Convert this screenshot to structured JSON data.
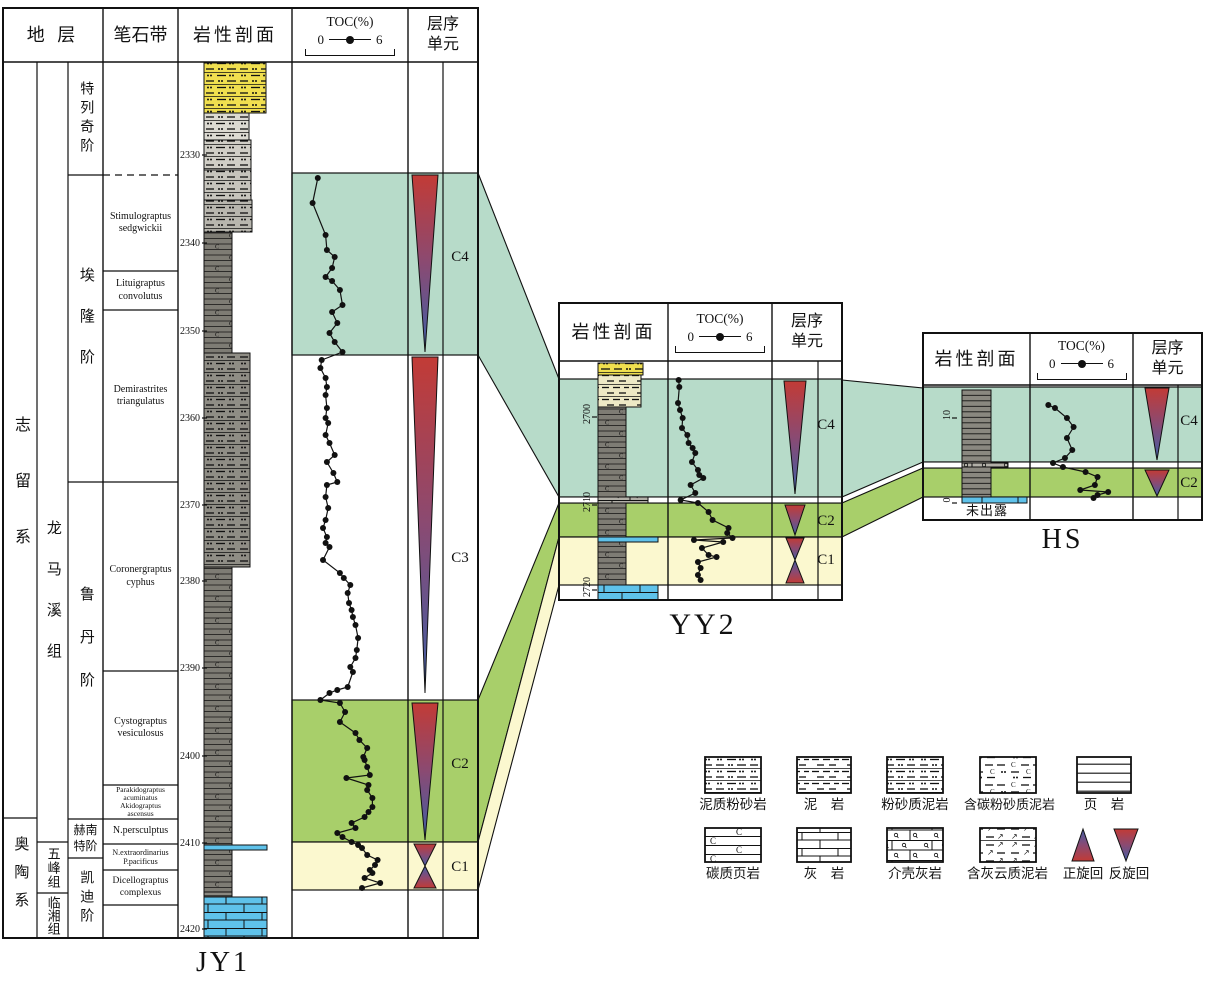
{
  "palette": {
    "teal": "#b7dbc9",
    "green": "#a8cf6a",
    "cream": "#fbf8cf",
    "red": "#c23b36",
    "blue": "#3f5fa7",
    "line": "#111111",
    "lith": {
      "yellow": "#f0df4f",
      "pale": "#eee9c5",
      "g1": "#dcdad2",
      "g15": "#d0cec6",
      "g2": "#c6c4bc",
      "g25": "#b8b6ae",
      "dk": "#7e7c74",
      "dkdash": "#8f8d85",
      "shale": "#8a8880",
      "blue": "#5fc2ea",
      "lime": "#5fc2ea",
      "shellb": "#b2b0a8"
    }
  },
  "headers": {
    "strata": "地 层",
    "biozone": "笔石带",
    "lithology": "岩性剖面",
    "toc_title": "TOC(%)",
    "toc_min": "0",
    "toc_max": "6",
    "sequence": "层序单元"
  },
  "jy1": {
    "well_label": "JY1",
    "series": [
      {
        "label": "志留系"
      },
      {
        "label": "奥陶系"
      }
    ],
    "formations": [
      {
        "label": "龙马溪组"
      },
      {
        "label": "五峰组"
      },
      {
        "label": "临湘组"
      }
    ],
    "stages": [
      {
        "label": "特列奇阶"
      },
      {
        "label": "埃隆阶"
      },
      {
        "label": "鲁丹阶"
      },
      {
        "label": "赫南特阶"
      },
      {
        "label": "凯迪阶"
      }
    ],
    "biozones": [
      {
        "label": "Stimulograptus\nsedgwickii"
      },
      {
        "label": "Lituigraptus\nconvolutus"
      },
      {
        "label": "Demirastrites\ntriangulatus"
      },
      {
        "label": "Coronergraptus\ncyphus"
      },
      {
        "label": "Cystograptus\nvesiculosus"
      },
      {
        "label": "Parakidograptus\nacuminatus\nAkidograptus\nascensus"
      },
      {
        "label": "N.persculptus"
      },
      {
        "label": "N.extraordinarius\nP.pacificus"
      },
      {
        "label": "Dicellograptus\ncomplexus"
      }
    ],
    "sequence_labels": [
      {
        "label": "C4"
      },
      {
        "label": "C3"
      },
      {
        "label": "C2"
      },
      {
        "label": "C1"
      }
    ],
    "toc_curve": [
      [
        178,
        0.6
      ],
      [
        203,
        0.2
      ],
      [
        235,
        1.2
      ],
      [
        250,
        1.3
      ],
      [
        257,
        1.9
      ],
      [
        268,
        1.7
      ],
      [
        277,
        1.2
      ],
      [
        281,
        1.7
      ],
      [
        290,
        2.3
      ],
      [
        305,
        2.5
      ],
      [
        312,
        1.7
      ],
      [
        323,
        2.1
      ],
      [
        333,
        1.5
      ],
      [
        342,
        1.9
      ],
      [
        352,
        2.5
      ],
      [
        360,
        0.9
      ],
      [
        368,
        0.8
      ],
      [
        378,
        1.2
      ],
      [
        387,
        1.3
      ],
      [
        395,
        1.2
      ],
      [
        408,
        1.3
      ],
      [
        418,
        1.2
      ],
      [
        423,
        1.4
      ],
      [
        435,
        1.2
      ],
      [
        443,
        1.5
      ],
      [
        455,
        1.9
      ],
      [
        462,
        1.3
      ],
      [
        473,
        1.8
      ],
      [
        482,
        2.1
      ],
      [
        485,
        1.3
      ],
      [
        497,
        1.2
      ],
      [
        508,
        1.4
      ],
      [
        520,
        1.2
      ],
      [
        528,
        1.0
      ],
      [
        537,
        1.3
      ],
      [
        543,
        1.2
      ],
      [
        547,
        1.5
      ],
      [
        560,
        1.0
      ],
      [
        573,
        2.3
      ],
      [
        578,
        2.6
      ],
      [
        585,
        3.1
      ],
      [
        593,
        2.9
      ],
      [
        603,
        3.0
      ],
      [
        610,
        3.2
      ],
      [
        617,
        3.3
      ],
      [
        625,
        3.5
      ],
      [
        638,
        3.7
      ],
      [
        650,
        3.6
      ],
      [
        658,
        3.5
      ],
      [
        667,
        3.1
      ],
      [
        672,
        3.3
      ],
      [
        687,
        2.9
      ],
      [
        690,
        2.1
      ],
      [
        693,
        1.5
      ],
      [
        700,
        0.8
      ],
      [
        703,
        2.3
      ],
      [
        712,
        2.7
      ],
      [
        722,
        2.3
      ],
      [
        733,
        3.5
      ],
      [
        740,
        3.8
      ],
      [
        748,
        4.4
      ],
      [
        757,
        4.1
      ],
      [
        760,
        4.2
      ],
      [
        767,
        4.4
      ],
      [
        775,
        4.6
      ],
      [
        778,
        2.8
      ],
      [
        785,
        4.5
      ],
      [
        790,
        4.4
      ],
      [
        798,
        4.8
      ],
      [
        807,
        4.8
      ],
      [
        812,
        4.5
      ],
      [
        817,
        4.2
      ],
      [
        823,
        3.2
      ],
      [
        828,
        3.5
      ],
      [
        833,
        2.1
      ],
      [
        837,
        2.5
      ],
      [
        842,
        3.2
      ],
      [
        845,
        3.7
      ],
      [
        848,
        4.0
      ],
      [
        855,
        4.4
      ],
      [
        860,
        5.2
      ],
      [
        865,
        5.0
      ],
      [
        870,
        4.6
      ],
      [
        873,
        4.8
      ],
      [
        878,
        4.2
      ],
      [
        883,
        5.4
      ],
      [
        888,
        4.0
      ]
    ],
    "gfx": {
      "frame": [
        3,
        8,
        475,
        930
      ],
      "header_bottom": 62,
      "cols": [
        103,
        178,
        292,
        408
      ],
      "body_cols": [
        37,
        68,
        443
      ],
      "hlines": [
        [
          3,
          37,
          818
        ],
        [
          37,
          68,
          842
        ],
        [
          37,
          68,
          893
        ],
        [
          68,
          103,
          175
        ],
        [
          68,
          103,
          482
        ],
        [
          68,
          103,
          819
        ],
        [
          68,
          103,
          858
        ],
        [
          103,
          178,
          271
        ],
        [
          103,
          178,
          310
        ],
        [
          103,
          178,
          482
        ],
        [
          103,
          178,
          671
        ],
        [
          103,
          178,
          785
        ],
        [
          103,
          178,
          819
        ],
        [
          103,
          178,
          844
        ],
        [
          103,
          178,
          870
        ],
        [
          103,
          178,
          905
        ]
      ],
      "dashed_hlines": [
        [
          103,
          178,
          175
        ]
      ],
      "band_x": [
        292,
        478
      ],
      "bands": [
        [
          "C4",
          "teal",
          173,
          355
        ],
        [
          "C2",
          "green",
          700,
          842
        ],
        [
          "C1",
          "cream",
          842,
          890
        ]
      ],
      "white_strips": [],
      "lith_x": 204,
      "lith": [
        [
          63,
          50,
          62,
          "yellow"
        ],
        [
          113,
          27,
          45,
          "g1"
        ],
        [
          140,
          30,
          47,
          "g15"
        ],
        [
          170,
          30,
          47,
          "g2"
        ],
        [
          200,
          32,
          48,
          "g25"
        ],
        [
          232,
          121,
          28,
          "dk"
        ],
        [
          353,
          214,
          46,
          "dkdash"
        ],
        [
          567,
          278,
          28,
          "dk"
        ],
        [
          845,
          5,
          63,
          "blue"
        ],
        [
          850,
          42,
          28,
          "dk"
        ],
        [
          892,
          5,
          28,
          "shale"
        ],
        [
          897,
          41,
          63,
          "lime"
        ]
      ],
      "ticks": {
        "x": 202,
        "rot": false,
        "items": [
          [
            "2330",
            155
          ],
          [
            "2340",
            243
          ],
          [
            "2350",
            331
          ],
          [
            "2360",
            418
          ],
          [
            "2370",
            505
          ],
          [
            "2380",
            581
          ],
          [
            "2390",
            668
          ],
          [
            "2400",
            756
          ],
          [
            "2410",
            843
          ],
          [
            "2420",
            929
          ]
        ]
      },
      "toc": {
        "x0": 310,
        "per": 13
      },
      "cycles": [
        [
          "rev",
          425,
          175,
          352,
          13
        ],
        [
          "rev",
          425,
          357,
          693,
          13
        ],
        [
          "rev",
          425,
          703,
          840,
          13
        ],
        [
          "rev",
          425,
          844,
          866,
          11
        ],
        [
          "fwd",
          425,
          866,
          888,
          11
        ]
      ]
    }
  },
  "yy2": {
    "well_label": "YY2",
    "sequence_labels": [
      {
        "label": "C4"
      },
      {
        "label": "C2"
      },
      {
        "label": "C1"
      }
    ],
    "toc_curve": [
      [
        380,
        0.05
      ],
      [
        387,
        0.1
      ],
      [
        403,
        0.0
      ],
      [
        410,
        0.15
      ],
      [
        418,
        0.35
      ],
      [
        428,
        0.3
      ],
      [
        435,
        0.7
      ],
      [
        443,
        0.8
      ],
      [
        448,
        1.1
      ],
      [
        453,
        1.3
      ],
      [
        462,
        1.05
      ],
      [
        470,
        1.5
      ],
      [
        475,
        1.6
      ],
      [
        478,
        1.9
      ],
      [
        485,
        0.95
      ],
      [
        493,
        1.3
      ],
      [
        500,
        0.2
      ],
      [
        503,
        1.5
      ],
      [
        512,
        2.3
      ],
      [
        520,
        2.6
      ],
      [
        528,
        3.8
      ],
      [
        533,
        3.7
      ],
      [
        538,
        4.1
      ],
      [
        540,
        1.2
      ],
      [
        542,
        3.4
      ],
      [
        548,
        1.8
      ],
      [
        555,
        2.3
      ],
      [
        557,
        2.9
      ],
      [
        562,
        1.5
      ],
      [
        568,
        1.7
      ],
      [
        575,
        1.5
      ],
      [
        580,
        1.7
      ]
    ],
    "gfx": {
      "frame": [
        559,
        303,
        283,
        297
      ],
      "header_bottom": 361,
      "cols": [
        668,
        772
      ],
      "body_cols": [
        818
      ],
      "hlines": [],
      "dashed_hlines": [],
      "band_x": [
        559,
        842
      ],
      "bands": [
        [
          "C4",
          "teal",
          379,
          497
        ],
        [
          "C2",
          "green",
          503,
          537
        ],
        [
          "C1",
          "cream",
          537,
          585
        ]
      ],
      "white_strips": [
        [
          559,
          497,
          283,
          6
        ]
      ],
      "lith_x": 598,
      "lith": [
        [
          363,
          12,
          45,
          "yellow"
        ],
        [
          375,
          32,
          43,
          "pale"
        ],
        [
          407,
          90,
          28,
          "dk"
        ],
        [
          497,
          6,
          50,
          "shellb"
        ],
        [
          503,
          34,
          28,
          "dk"
        ],
        [
          537,
          5,
          60,
          "blue"
        ],
        [
          542,
          43,
          28,
          "dk"
        ],
        [
          585,
          15,
          60,
          "lime"
        ]
      ],
      "ticks": {
        "x": 592,
        "rot": true,
        "items": [
          [
            "2700",
            417
          ],
          [
            "2710",
            505
          ],
          [
            "2720",
            590
          ]
        ]
      },
      "toc": {
        "x0": 678,
        "per": 13.3
      },
      "cycles": [
        [
          "rev",
          795,
          381,
          494,
          11
        ],
        [
          "rev",
          795,
          505,
          535,
          10
        ],
        [
          "rev",
          795,
          538,
          560,
          9
        ],
        [
          "fwd",
          795,
          560,
          583,
          9
        ]
      ]
    }
  },
  "hs": {
    "well_label": "HS",
    "not_exposed": "未出露",
    "sequence_labels": [
      {
        "label": "C4"
      },
      {
        "label": "C2"
      }
    ],
    "toc_curve": [
      [
        405,
        0.1
      ],
      [
        408,
        0.6
      ],
      [
        418,
        1.5
      ],
      [
        427,
        2.0
      ],
      [
        438,
        1.5
      ],
      [
        450,
        1.9
      ],
      [
        458,
        1.35
      ],
      [
        463,
        0.45
      ],
      [
        467,
        1.2
      ],
      [
        472,
        2.9
      ],
      [
        477,
        3.8
      ],
      [
        485,
        3.6
      ],
      [
        490,
        2.5
      ],
      [
        492,
        4.6
      ],
      [
        495,
        3.8
      ],
      [
        498,
        3.5
      ]
    ],
    "gfx": {
      "frame": [
        923,
        333,
        279,
        187
      ],
      "header_bottom": 385,
      "cols": [
        1030,
        1133
      ],
      "body_cols": [
        1178
      ],
      "hlines": [],
      "dashed_hlines": [],
      "band_x": [
        923,
        1202
      ],
      "bands": [
        [
          "C4",
          "teal",
          387,
          462
        ],
        [
          "C2",
          "green",
          468,
          497
        ]
      ],
      "white_strips": [
        [
          923,
          462,
          279,
          6
        ]
      ],
      "lith_x": 962,
      "lith": [
        [
          390,
          73,
          29,
          "shale"
        ],
        [
          463,
          4,
          46,
          "shellb"
        ],
        [
          467,
          30,
          29,
          "shale"
        ],
        [
          497,
          6,
          65,
          "lime"
        ]
      ],
      "ticks": {
        "x": 952,
        "rot": true,
        "items": [
          [
            "10",
            418
          ],
          [
            "0",
            503
          ]
        ]
      },
      "toc": {
        "x0": 1047,
        "per": 13.3
      },
      "cycles": [
        [
          "rev",
          1157,
          388,
          460,
          12
        ],
        [
          "rev",
          1157,
          470,
          496,
          12
        ]
      ]
    }
  },
  "connections": [
    [
      "teal",
      [
        [
          478,
          173
        ],
        [
          559,
          379
        ],
        [
          559,
          497
        ],
        [
          478,
          355
        ]
      ]
    ],
    [
      "green",
      [
        [
          478,
          700
        ],
        [
          559,
          503
        ],
        [
          559,
          537
        ],
        [
          478,
          842
        ]
      ]
    ],
    [
      "cream",
      [
        [
          478,
          842
        ],
        [
          559,
          537
        ],
        [
          559,
          585
        ],
        [
          478,
          890
        ]
      ]
    ],
    [
      "teal",
      [
        [
          842,
          380
        ],
        [
          923,
          388
        ],
        [
          923,
          462
        ],
        [
          842,
          497
        ]
      ]
    ],
    [
      "green",
      [
        [
          842,
          503
        ],
        [
          923,
          468
        ],
        [
          923,
          497
        ],
        [
          842,
          537
        ]
      ]
    ]
  ],
  "legend": {
    "items": [
      {
        "label": "泥质粉砂岩",
        "pattern": "dotdash"
      },
      {
        "label": "泥　岩",
        "pattern": "dash"
      },
      {
        "label": "粉砂质泥岩",
        "pattern": "dashdot"
      },
      {
        "label": "含碳粉砂质泥岩",
        "pattern": "cdash"
      },
      {
        "label": "页　岩",
        "pattern": "lines"
      },
      {
        "label": "碳质页岩",
        "pattern": "clines"
      },
      {
        "label": "灰　岩",
        "pattern": "brick"
      },
      {
        "label": "介壳灰岩",
        "pattern": "shellbrick"
      },
      {
        "label": "含灰云质泥岩",
        "pattern": "arrowdash"
      },
      {
        "label": "正旋回",
        "pattern": "cycle-up"
      },
      {
        "label": "反旋回",
        "pattern": "cycle-down"
      }
    ],
    "gfx": {
      "swatches": [
        [
          705,
          757,
          56,
          36,
          "l_dotdash"
        ],
        [
          797,
          757,
          54,
          36,
          "l_dash"
        ],
        [
          887,
          757,
          56,
          36,
          "l_dashdot"
        ],
        [
          980,
          757,
          56,
          36,
          "l_cdash"
        ],
        [
          1077,
          757,
          54,
          36,
          "l_lines"
        ],
        [
          705,
          828,
          56,
          34,
          "l_clines"
        ],
        [
          797,
          828,
          54,
          34,
          "l_brick"
        ],
        [
          887,
          828,
          56,
          34,
          "l_shellb"
        ],
        [
          980,
          828,
          56,
          34,
          "l_arrow"
        ]
      ],
      "cycles": [
        [
          "fwd",
          1083,
          829,
          861,
          11
        ],
        [
          "rev",
          1126,
          829,
          861,
          12
        ]
      ]
    }
  }
}
